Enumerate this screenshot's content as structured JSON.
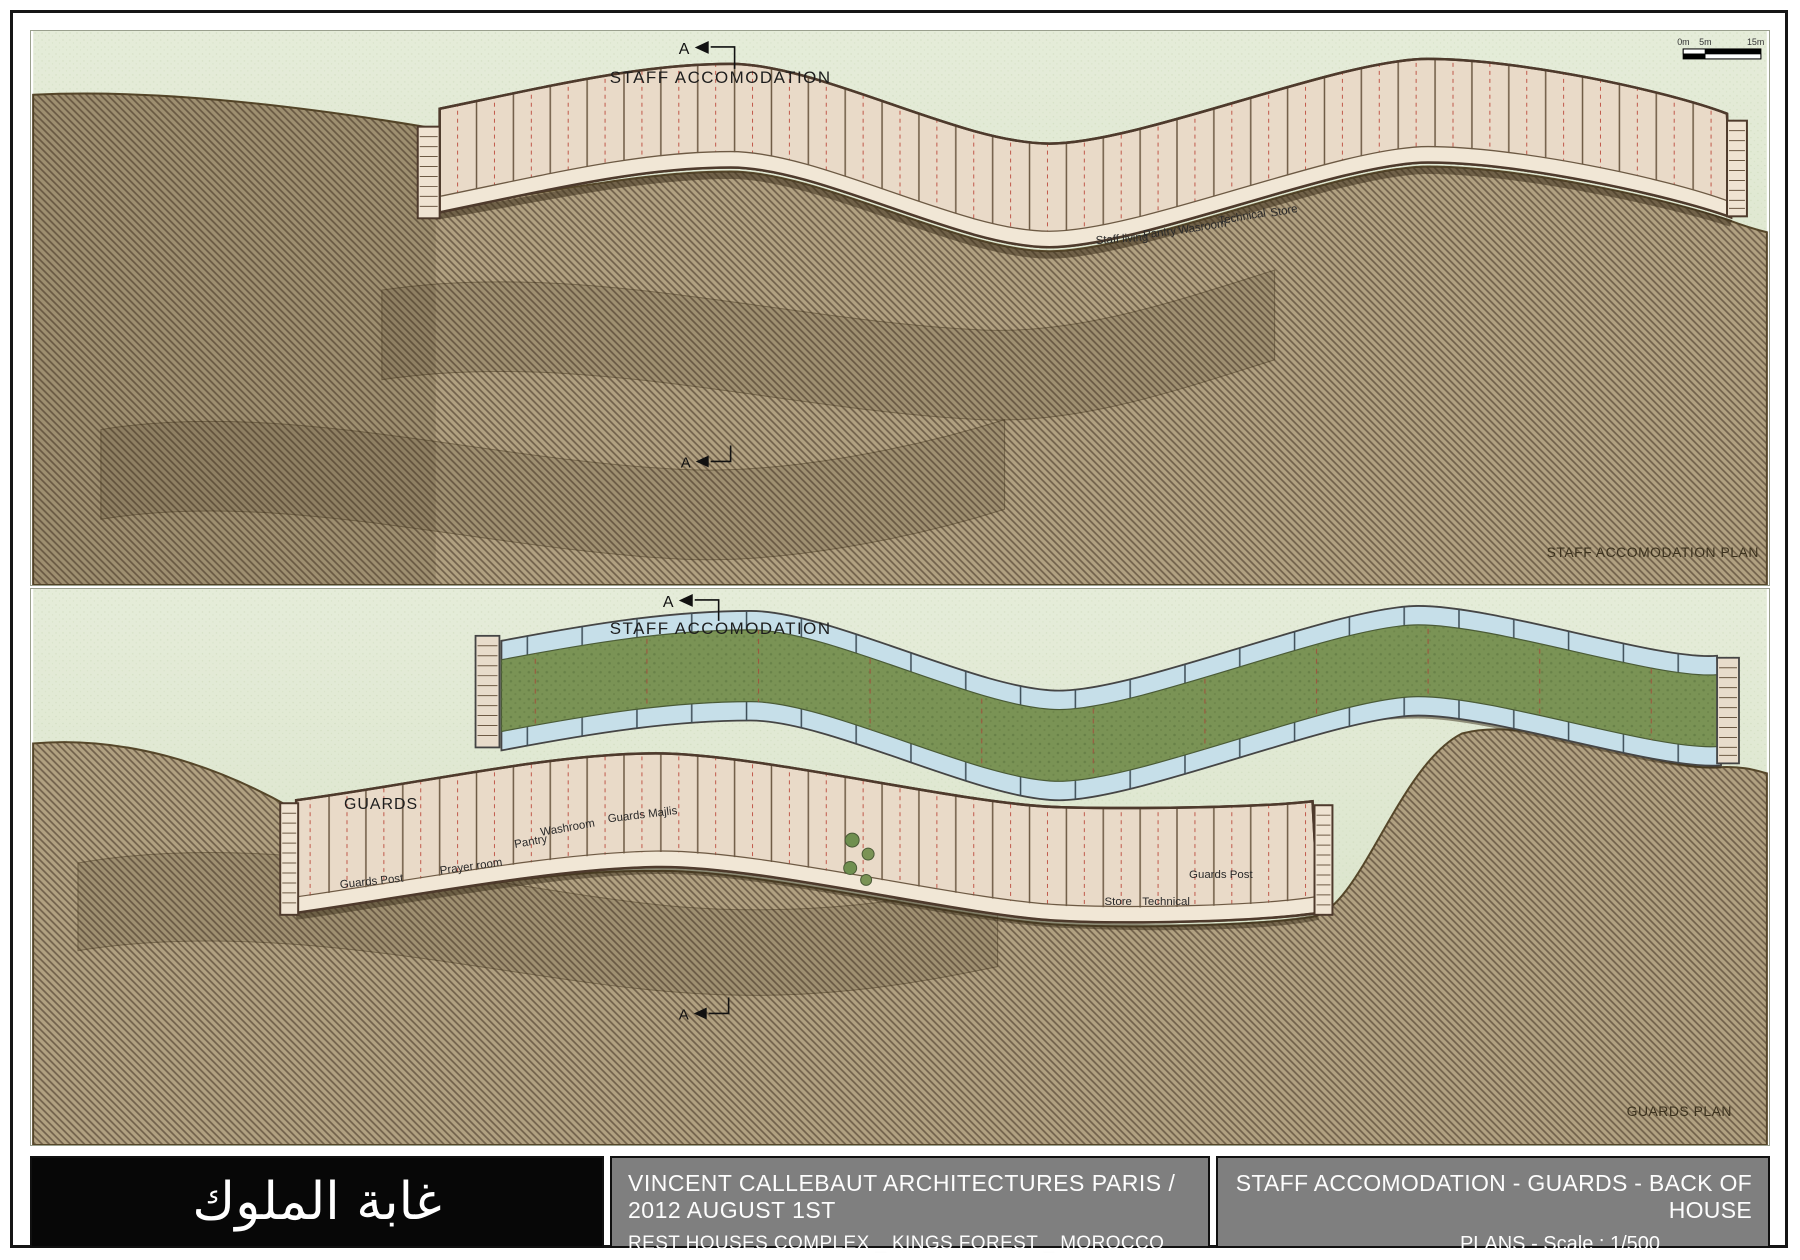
{
  "panel1": {
    "section_marker_top": "A",
    "section_marker_bottom": "A",
    "heading": "STAFF ACCOMODATION",
    "caption": "STAFF ACCOMODATION PLAN",
    "scale_bar": {
      "labels": [
        "0m",
        "5m",
        "15m"
      ]
    },
    "rooms": [
      "Staff living",
      "Pantry",
      "Wasroom",
      "Technical",
      "Store"
    ]
  },
  "panel2": {
    "section_marker_top": "A",
    "section_marker_bottom": "A",
    "heading": "STAFF ACCOMODATION",
    "guards_label": "GUARDS",
    "caption": "GUARDS PLAN",
    "rooms_left": [
      "Guards Post",
      "Prayer room",
      "Pantry",
      "Washroom",
      "Guards Majlis"
    ],
    "rooms_right": [
      "Store",
      "Technical",
      "Guards Post"
    ]
  },
  "title_block": {
    "project_name_arabic": "غابة الملوك",
    "architect_line": "VINCENT CALLEBAUT ARCHITECTURES PARIS / 2012 AUGUST 1ST",
    "project_line": "REST HOUSES COMPLEX _ KINGS FOREST _ MOROCCO",
    "sheet_title_line1": "STAFF ACCOMODATION - GUARDS - BACK OF HOUSE",
    "sheet_title_line2": "PLANS  -  Scale : 1/500"
  },
  "colors": {
    "grass": "#dde6cf",
    "terrain": "#b1a181",
    "terrain_hatch": "#70604a",
    "building_floor": "#e9dac8",
    "building_wall": "#4e3a2c",
    "roof_green": "#7a9355",
    "water_blue": "#c6dfe9",
    "red_partition": "#c0584a",
    "titlebar_gray": "#7f7f7f",
    "titlebar_black": "#070707"
  }
}
